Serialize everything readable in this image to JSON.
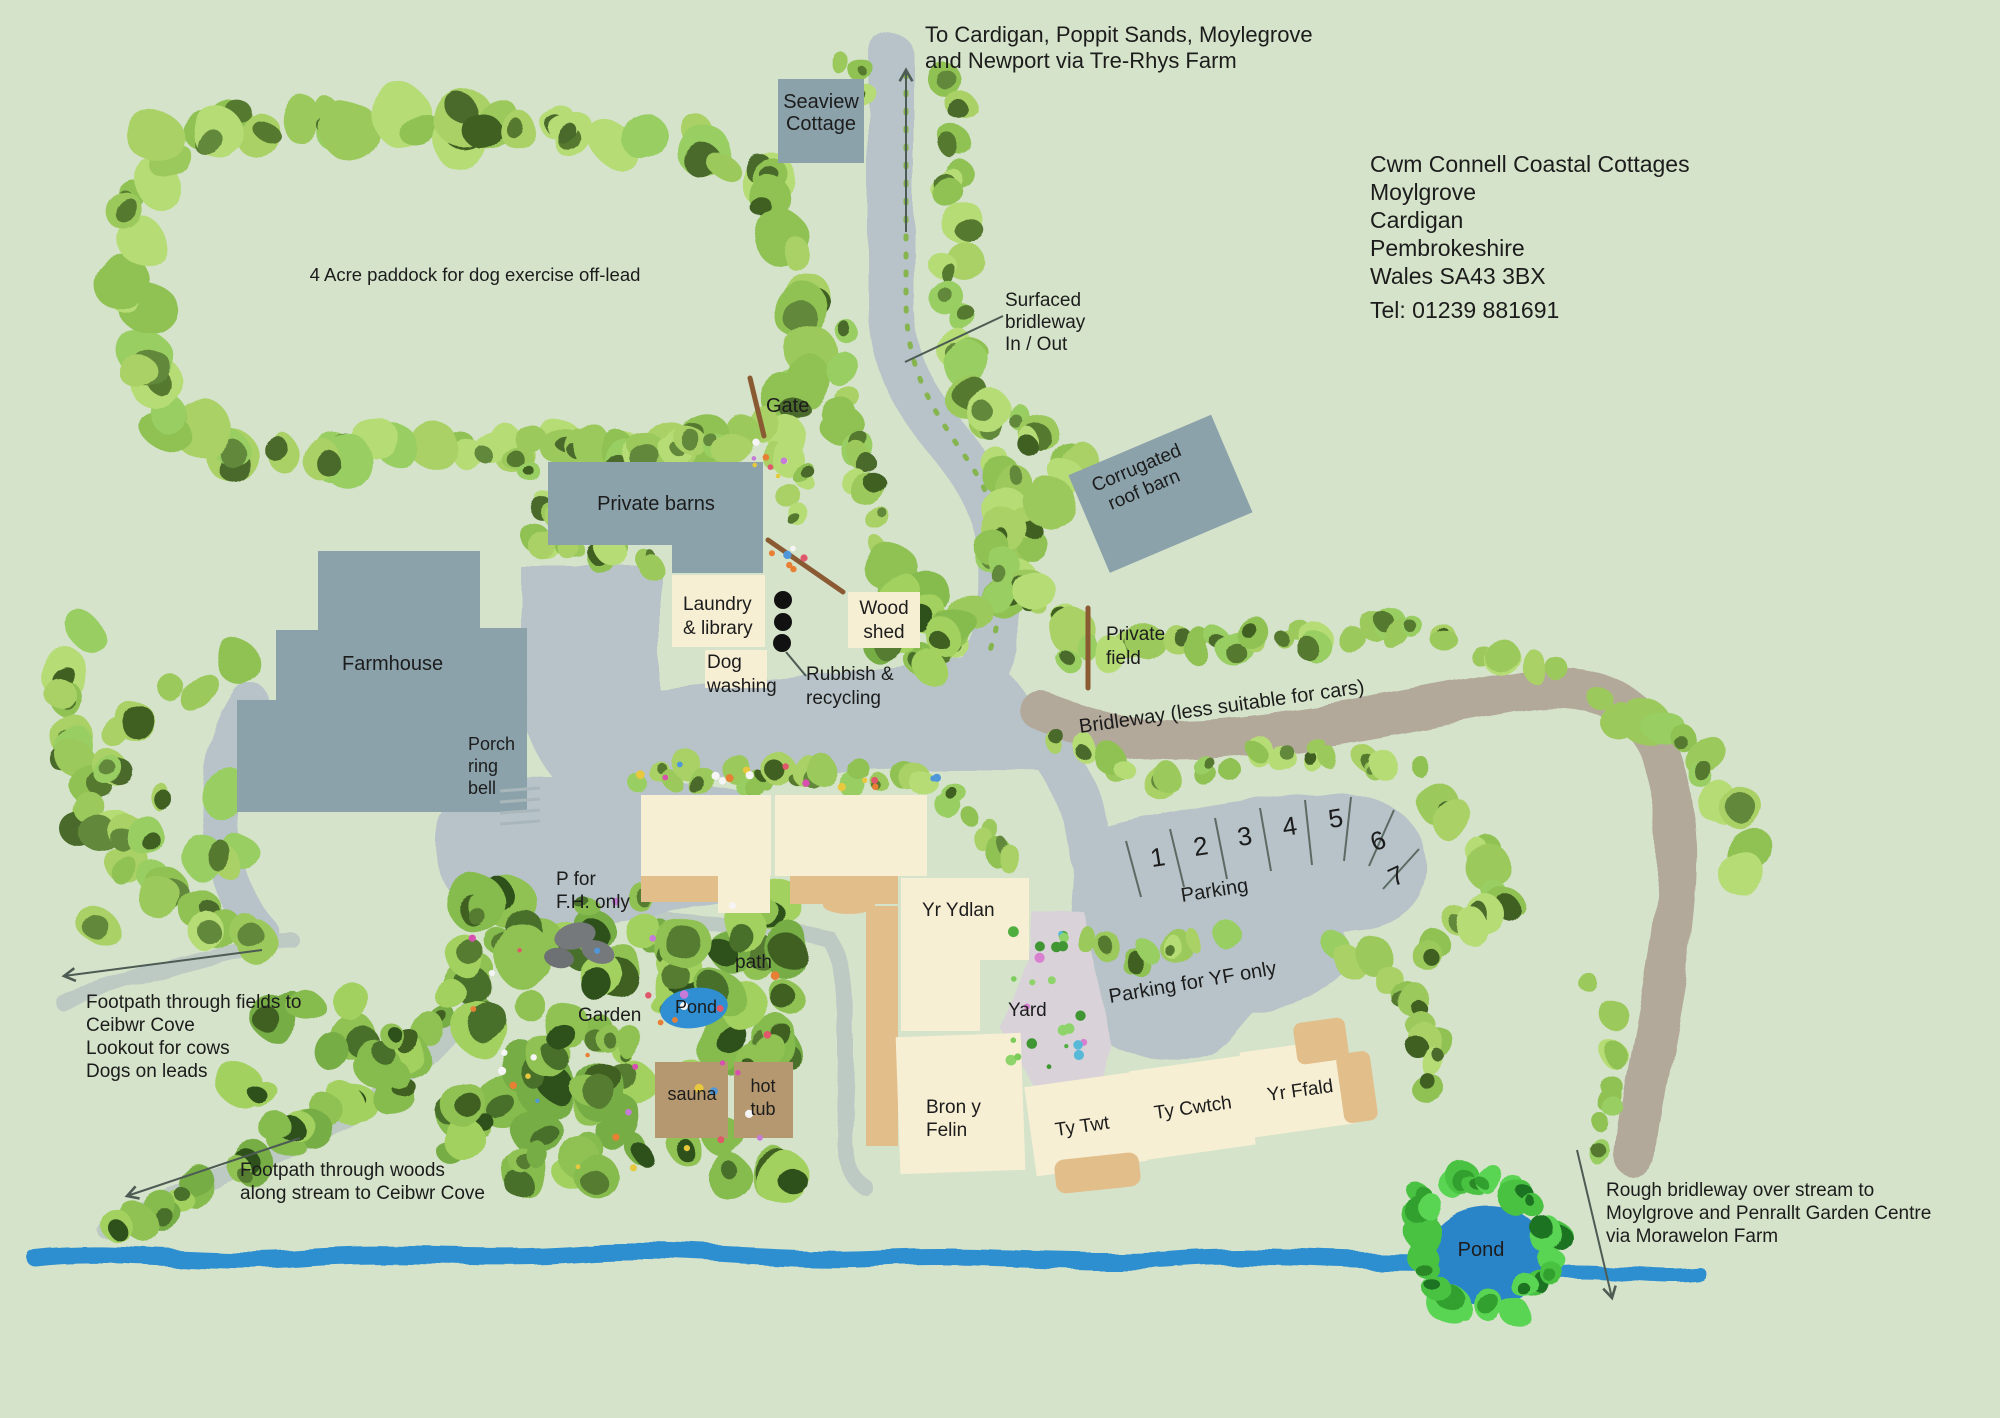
{
  "colors": {
    "background": "#d5e3ca",
    "road": "#b7c3c8",
    "building": "#8ba2ab",
    "cottage": "#f7efd4",
    "patio": "#e2be8a",
    "timber": "#b5986f",
    "bridleway": "#b3a99b",
    "yard": "#d9d3d9",
    "stream": "#2e8fd0",
    "pond": "#2b85c8",
    "footpath": "#bdc9c3",
    "fence": "#8a5a33",
    "rock": "#75797c",
    "grass_line": "#86b44e",
    "arrow": "#4c5b53",
    "text": "#1c1c1c"
  },
  "header": {
    "destination": [
      "To Cardigan, Poppit Sands, Moylegrove",
      "and Newport via Tre-Rhys Farm"
    ],
    "address": [
      "Cwm Connell Coastal Cottages",
      "Moylgrove",
      "Cardigan",
      "Pembrokeshire",
      "Wales SA43 3BX"
    ],
    "phone": "Tel: 01239 881691"
  },
  "buildings": {
    "seaview": [
      "Seaview",
      "Cottage"
    ],
    "private_barns": "Private barns",
    "farmhouse": "Farmhouse",
    "corrugated_barn": [
      "Corrugated",
      "roof barn"
    ],
    "laundry": [
      "Laundry",
      "& library"
    ],
    "dog_washing": [
      "Dog",
      "washing"
    ],
    "wood_shed": [
      "Wood",
      "shed"
    ],
    "fron_haul": "Fron Haul",
    "ger_y_llyn": "Ger y Llyn",
    "yr_ydlan": "Yr Ydlan",
    "bron_y_felin": [
      "Bron y",
      "Felin"
    ],
    "ty_twt": "Ty Twt",
    "ty_cwtch": "Ty Cwtch",
    "yr_ffald": "Yr Ffald",
    "sauna": "sauna",
    "hot_tub": [
      "hot",
      "tub"
    ]
  },
  "labels": {
    "paddock": "4 Acre paddock for dog exercise off-lead",
    "gate": "Gate",
    "surfaced_bridleway": [
      "Surfaced",
      "bridleway",
      "In / Out"
    ],
    "private_field": [
      "Private",
      "field"
    ],
    "porch": [
      "Porch",
      "ring",
      "bell"
    ],
    "bridleway_cars": "Bridleway (less suitable for cars)",
    "p_for_fh": [
      "P for",
      "F.H. only"
    ],
    "path": "path",
    "garden": "Garden",
    "pond_garden": "Pond",
    "pond_main": "Pond",
    "yard": "Yard",
    "parking_yf": "Parking for YF only",
    "rubbish": [
      "Rubbish &",
      "recycling"
    ],
    "footpath_fields": [
      "Footpath through fields to",
      "Ceibwr Cove",
      "Lookout for cows",
      "Dogs on leads"
    ],
    "footpath_woods": [
      "Footpath through woods",
      "along stream to Ceibwr Cove"
    ],
    "rough_bridleway": [
      "Rough bridleway over stream to",
      "Moylgrove and Penrallt Garden Centre",
      "via Morawelon Farm"
    ]
  },
  "parking": {
    "title": "Parking",
    "bays": [
      "1",
      "2",
      "3",
      "4",
      "5",
      "6",
      "7"
    ]
  }
}
